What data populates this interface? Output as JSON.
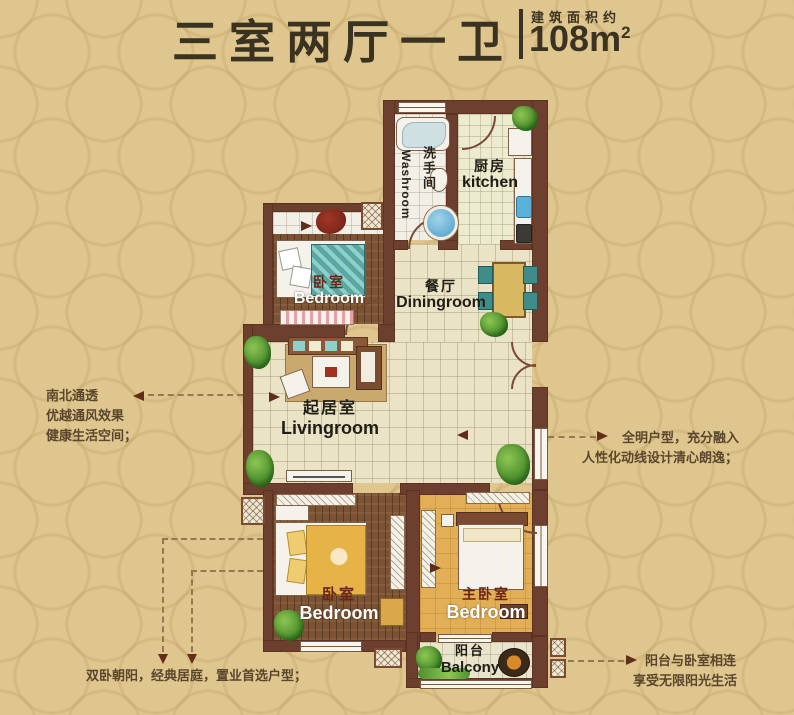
{
  "header": {
    "title": "三室两厅一卫",
    "area_label": "建筑面积约",
    "area_value": "108m",
    "area_sup": "2"
  },
  "rooms": {
    "washroom": {
      "cn": "洗手间",
      "en": "Washroom"
    },
    "kitchen": {
      "cn": "厨房",
      "en": "kitchen"
    },
    "bedroom_top": {
      "cn": "卧室",
      "en": "Bedroom"
    },
    "dining": {
      "cn": "餐厅",
      "en": "Diningroom"
    },
    "living": {
      "cn": "起居室",
      "en": "Livingroom"
    },
    "bedroom_left": {
      "cn": "卧室",
      "en": "Bedroom"
    },
    "bedroom_master": {
      "cn": "主卧室",
      "en": "Bedroom"
    },
    "balcony": {
      "cn": "阳台",
      "en": "Balcony"
    }
  },
  "annotations": {
    "left": [
      "南北通透",
      "优越通风效果",
      "健康生活空间；"
    ],
    "right": [
      "全明户型，充分融入",
      "人性化动线设计清心朗逸；"
    ],
    "bottom_left": [
      "双卧朝阳，经典居庭，置业首选户型；"
    ],
    "bottom_right": [
      "阳台与卧室相连",
      "享受无限阳光生活"
    ]
  },
  "colors": {
    "background": "#dfc68e",
    "wall": "#6d3f2e",
    "title_text": "#3b3322",
    "annotation_text": "#5a462c",
    "tile_floor": "#eae3c6",
    "wood_floor": "#7b5334",
    "master_floor": "#e2af56"
  }
}
